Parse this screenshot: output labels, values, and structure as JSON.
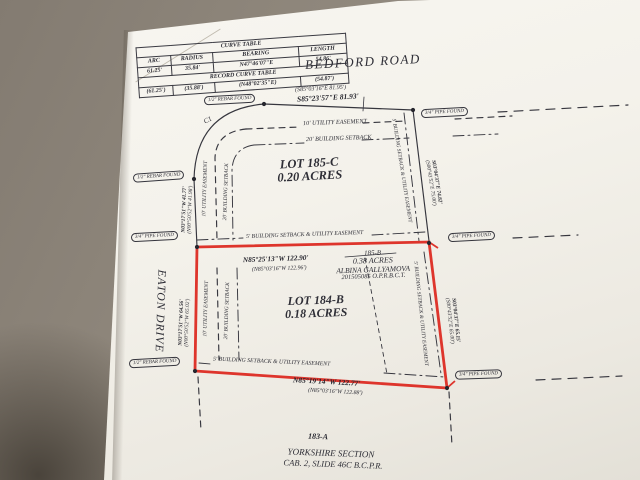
{
  "curve_table": {
    "title": "CURVE TABLE",
    "headers": [
      "ARC",
      "RADIUS",
      "BEARING",
      "LENGTH"
    ],
    "row": [
      "61.25'",
      "35.84'",
      "N47°46'07\"E",
      "54.86'"
    ],
    "record_title": "RECORD CURVE TABLE",
    "record_row": [
      "(61.25')",
      "(35.88')",
      "(N48°02'35\"E)",
      "(54.87')"
    ]
  },
  "roads": {
    "bedford": "BEDFORD ROAD",
    "eaton": "EATON DRIVE"
  },
  "curve_label": "C1",
  "monuments": {
    "rebar_half": "1/2\" REBAR FOUND",
    "pipe_three_quarter": "3/4\" PIPE FOUND"
  },
  "bearings": {
    "bedford": {
      "measured": "S85°23'57\"E  81.93'",
      "record": "(S85°03'16\"E  81.95')"
    },
    "eaton_north": {
      "measured": "N03°17'51\"W  41.77'",
      "record": "(N00°50'52\"W  41.98')"
    },
    "eaton_south": {
      "measured": "N03°17'51\"W  64.56'",
      "record": "(N00°50'52\"W  65.02')"
    },
    "east_upper": {
      "measured": "S03°04'37\"E  74.82'",
      "record": "(S00°43'52\"E  75.00')"
    },
    "east_lower": {
      "measured": "S03°04'37\"E  65.15'",
      "record": "(S00°43'52\"E  65.00')"
    },
    "middle": {
      "measured": "N85°25'13\"W  122.90'",
      "record": "(N85°03'16\"W  122.96')"
    },
    "south": {
      "measured": "N85°19'14\"W  122.77'",
      "record": "(N85°03'16\"W  122.88')"
    }
  },
  "lots": {
    "lot_185c": {
      "name": "LOT 185-C",
      "area": "0.20 ACRES"
    },
    "lot_184b": {
      "name": "LOT 184-B",
      "area": "0.18 ACRES"
    },
    "tract_185b": {
      "name": "185-B",
      "area": "0.38 ACRES",
      "owner": "ALBINA GALLYAMOVA",
      "instrument": "201505085 O.P.R.B.C.T."
    },
    "tract_183a": "183-A"
  },
  "easements": {
    "utility10": "10' UTILITY EASEMENT",
    "setback20": "20' BUILDING SETBACK",
    "setback5": "5' BUILDING SETBACK & UTILITY EASEMENT"
  },
  "footer": {
    "section": "YORKSHIRE SECTION",
    "reference": "CAB. 2, SLIDE 46C B.C.P.R."
  }
}
